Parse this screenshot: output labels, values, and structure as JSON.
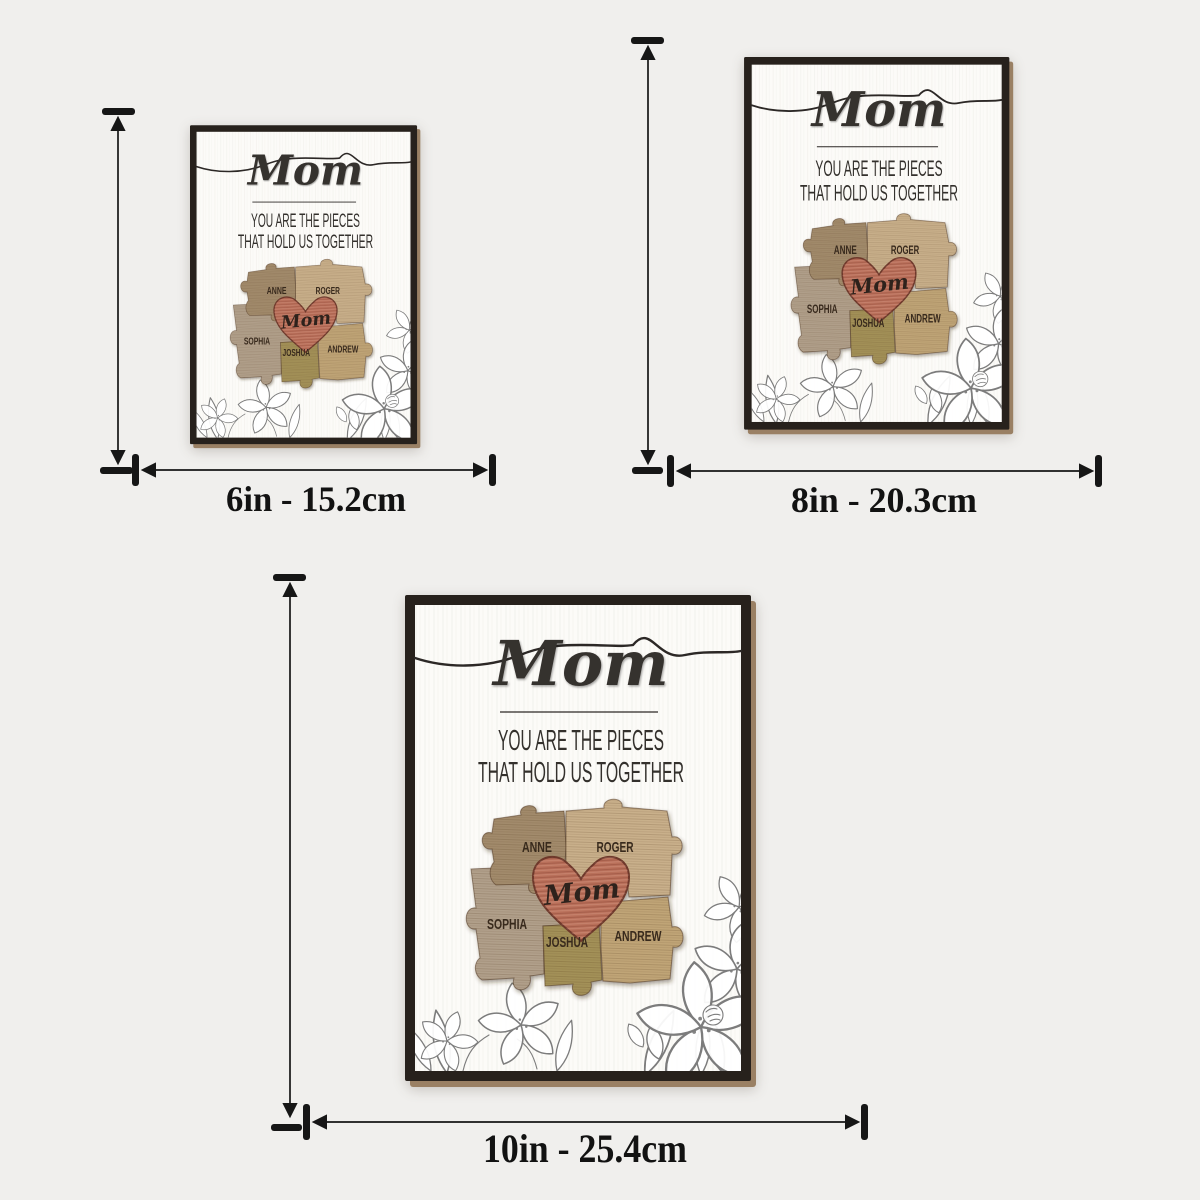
{
  "product": {
    "title": "Mom",
    "caption_line1": "YOU ARE THE PIECES",
    "caption_line2": "THAT HOLD US TOGETHER",
    "heart_text": "Mom",
    "puzzle_names": [
      "ANNE",
      "ROGER",
      "SOPHIA",
      "JOSHUA",
      "ANDREW"
    ],
    "colors": {
      "frame": "#27211c",
      "backing_edge": "#9a8064",
      "panel": "#fcfbf8",
      "ink": "#2c2826",
      "heart": "#b96f5a",
      "heart_outline": "#6e392c",
      "piece_anne": "#a28b6c",
      "piece_roger": "#c9b08b",
      "piece_sophia": "#b1a08b",
      "piece_joshua": "#a39158",
      "piece_andrew": "#c0a577",
      "name_text": "#38291e",
      "floral_line": "#7c7c7c",
      "dimension_ink": "#161616",
      "background": "#f0efed"
    }
  },
  "sizes": [
    {
      "label": "6in - 15.2cm"
    },
    {
      "label": "8in - 20.3cm"
    },
    {
      "label": "10in - 25.4cm"
    }
  ]
}
